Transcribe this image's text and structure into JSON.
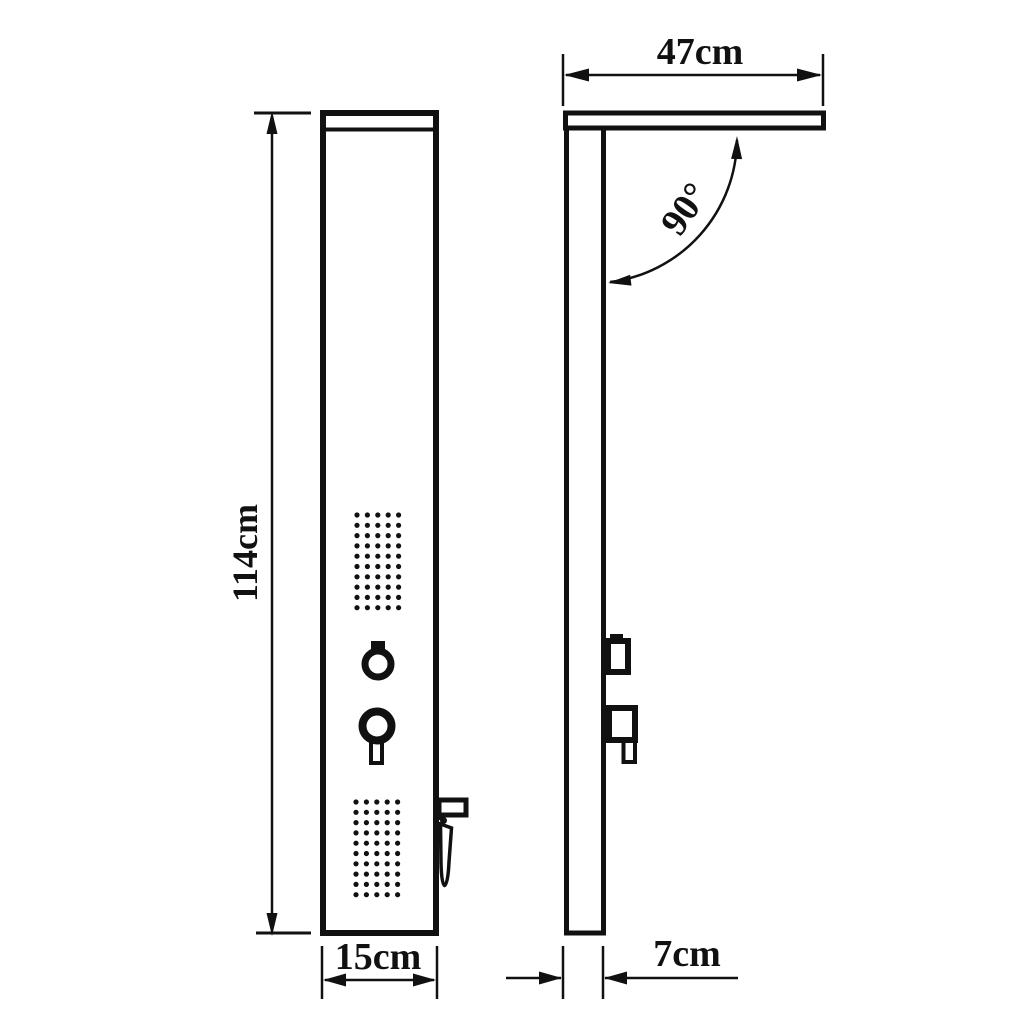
{
  "page": {
    "title": "Shower panel technical dimension drawing",
    "background": "#ffffff",
    "ink": "#111111"
  },
  "labels": {
    "front_height": "114cm",
    "front_width": "15cm",
    "side_arm_length": "47cm",
    "side_angle": "90°",
    "side_depth": "7cm"
  },
  "jet_grids": [
    {
      "name": "upper-jet-grid",
      "cols": 5,
      "rows": 10,
      "x": 357,
      "y": 515,
      "dx": 10.4,
      "dy": 10.3,
      "r": 2.6
    },
    {
      "name": "lower-jet-grid",
      "cols": 5,
      "rows": 10,
      "x": 356,
      "y": 802,
      "dx": 10.4,
      "dy": 10.3,
      "r": 2.6
    }
  ]
}
